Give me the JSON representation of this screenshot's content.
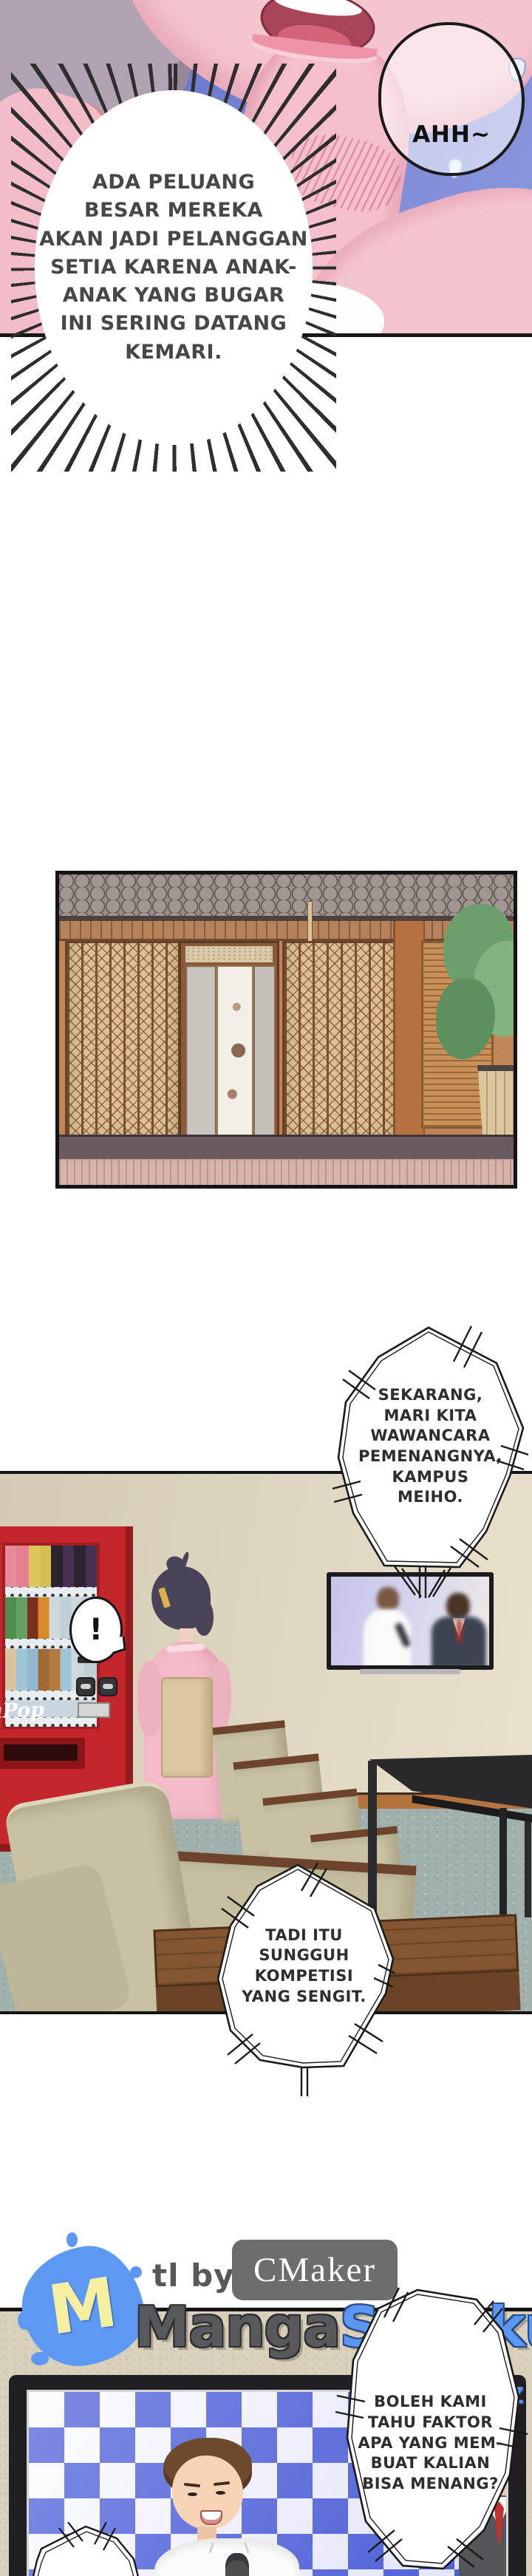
{
  "bubbles": {
    "ahh": "AHH~",
    "narration": "ADA PELUANG\nBESAR MEREKA\nAKAN JADI PELANGGAN\nSETIA KARENA ANAK-\nANAK YANG BUGAR\nINI SERING DATANG\nKEMARI.",
    "tv_announce": "SEKARANG,\nMARI KITA\nWAWANCARA\nPEMENANGNYA,\nKAMPUS\nMEIHO.",
    "exclaim": "!",
    "tv_comment": "TADI ITU\nSUNGGUH\nKOMPETISI\nYANG SENGIT.",
    "tv_question": "BOLEH KAMI\nTAHU FAKTOR\nAPA YANG MEM-\nBUAT KALIAN\nBISA MENANG?"
  },
  "scene": {
    "vending_machine_label": "aPop"
  },
  "credits": {
    "tl_by": "tl by",
    "translator": "CMaker",
    "logo_letter": "M",
    "site_name_part1": "Manga",
    "site_name_part2": "Susuku",
    "site_tld": ".XYZ"
  },
  "colors": {
    "accent_blue": "#5b97f0",
    "logo_gray": "#58595b",
    "machine_red": "#c5262b",
    "kimono_pink": "#f2bbc7",
    "panel_sky_blue": "#7381cf",
    "wall_tan": "#ddd4bd",
    "carpet_gray_green": "#9fb0ad",
    "checker_blue": "#4c5ed8",
    "tie_red": "#bf3431",
    "wood_brown": "#7d5130",
    "couch_olive": "#c6c0a0"
  }
}
